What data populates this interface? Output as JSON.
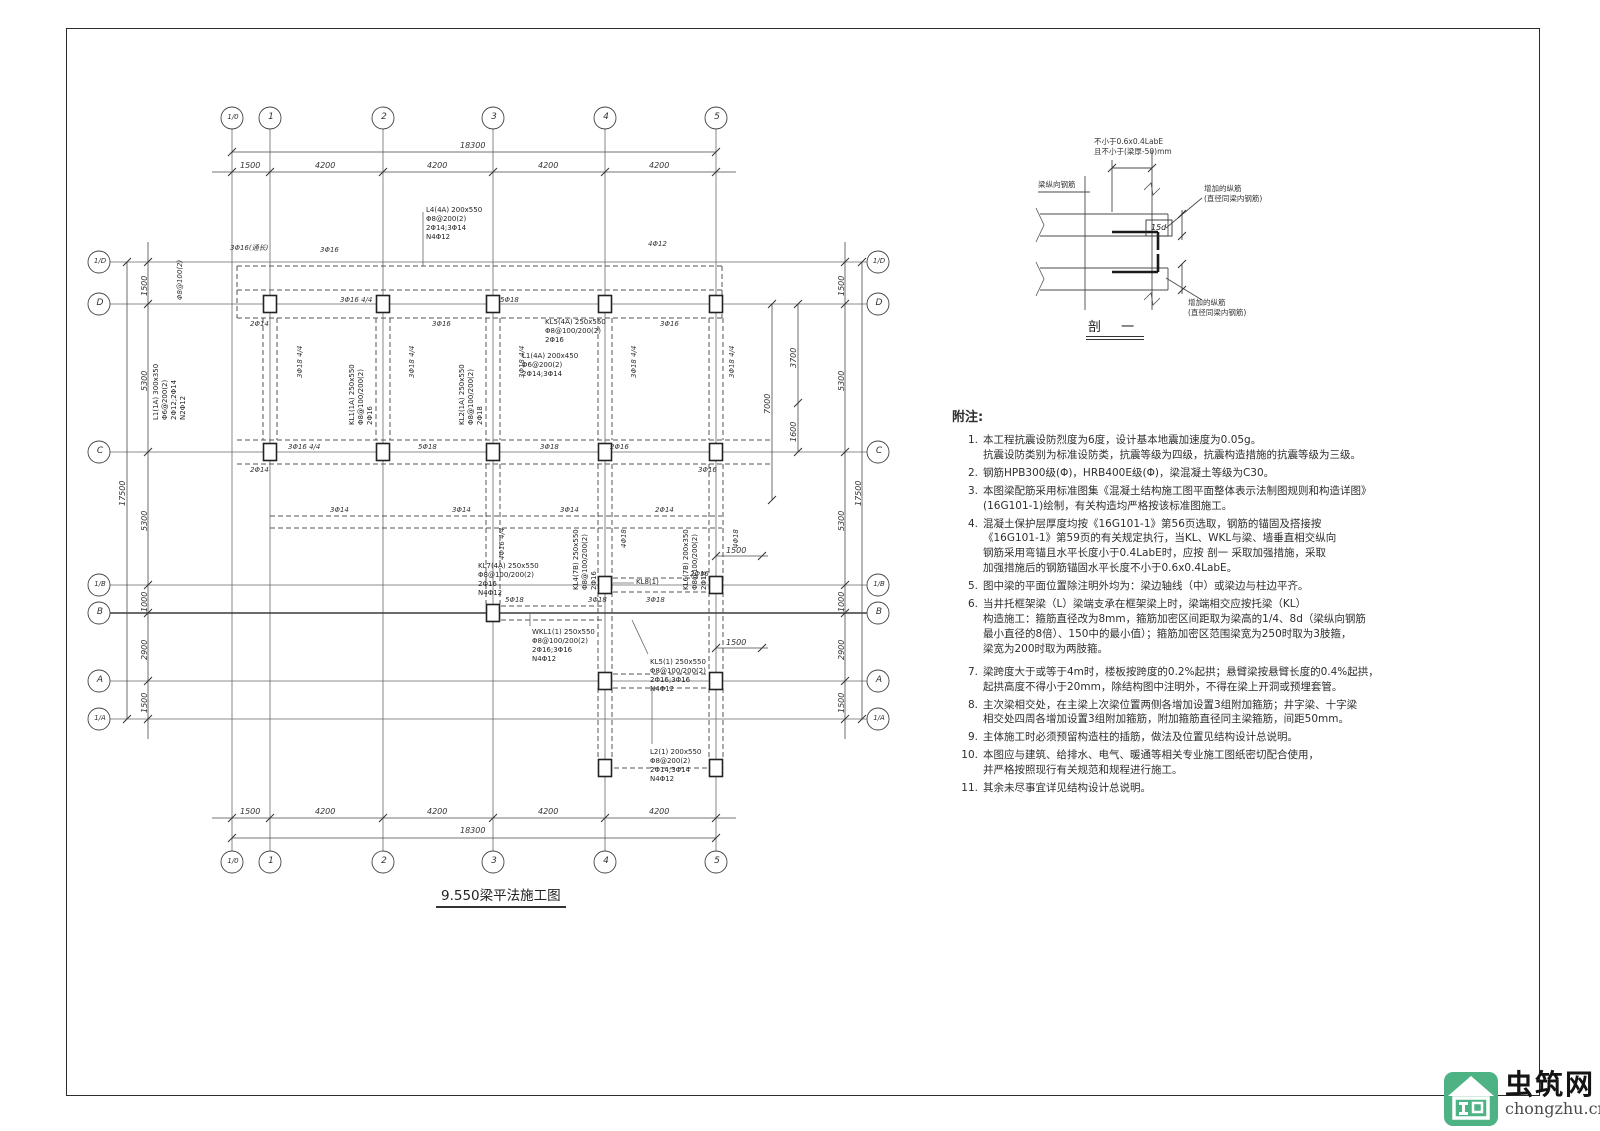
{
  "title": {
    "text": "9.550梁平法施工图"
  },
  "plan": {
    "axes_top": [
      "1/0",
      "1",
      "2",
      "3",
      "4",
      "5"
    ],
    "axes_bottom": [
      "1/0",
      "1",
      "2",
      "3",
      "4",
      "5"
    ],
    "axes_left": [
      "1/D",
      "D",
      "C",
      "1/B",
      "B",
      "A",
      "1/A"
    ],
    "axes_right": [
      "1/D",
      "D",
      "C",
      "1/B",
      "B",
      "A",
      "1/A"
    ],
    "dims_top": [
      "1500",
      "4200",
      "4200",
      "4200",
      "4200"
    ],
    "dims_top_total": "18300",
    "dims_bottom": [
      "1500",
      "4200",
      "4200",
      "4200",
      "4200"
    ],
    "dims_bottom_total": "18300",
    "dims_left": [
      "1500",
      "5300",
      "5300",
      "1000",
      "2900",
      "1500"
    ],
    "dims_left_total": "17500",
    "dims_right": [
      "1500",
      "5300",
      "5300",
      "1000",
      "2900",
      "1500"
    ],
    "dims_right_total": "17500",
    "dims_inner": [
      "7000",
      "3700",
      "1600",
      "1500",
      "1500"
    ],
    "labels": [
      "L4(4A) 200x550\nΦ8@200(2)\n2Φ14;3Φ14\nN4Φ12",
      "L1(1A) 300x350\nΦ6@200(2)\n2Φ12;2Φ14\nN2Φ12",
      "KL1(1A) 250x550\nΦ8@100/200(2)\n2Φ16",
      "KL2(1A) 250x550\nΦ8@100/200(2)\n2Φ18",
      "KL5(4A) 250x550\nΦ8@100/200(2)\n2Φ16",
      "L1(4A) 200x450\nΦ6@200(2)\n2Φ14;3Φ14",
      "KL7(4A) 250x550\nΦ8@100/200(2)\n2Φ16\nN4Φ12",
      "KL4(7B) 250x550\nΦ8@100/200(2)\n2Φ16",
      "KL6(7B) 200x350\nΦ8@100/200(2)\n2Φ18",
      "WKL1(1) 250x550\nΦ8@100/200(2)\n2Φ16;3Φ16\nN4Φ12",
      "KL5(1) 250x550\nΦ8@100/200(2)\n2Φ16;3Φ16\nN4Φ12",
      "L2(1) 200x550\nΦ8@200(2)\n2Φ14;3Φ14\nN4Φ12",
      "KL8(1)"
    ],
    "tags": [
      "3Φ16(通长)",
      "3Φ16",
      "4Φ12",
      "3Φ16 4/4",
      "5Φ18",
      "3Φ16",
      "3Φ16",
      "2Φ14",
      "Φ8@100(2)",
      "3Φ16 4/4",
      "2Φ14",
      "5Φ18",
      "3Φ18",
      "2Φ16",
      "3Φ16",
      "3Φ14",
      "3Φ14",
      "3Φ14",
      "2Φ14",
      "5Φ18",
      "3Φ18",
      "3Φ18",
      "2Φ16",
      "3Φ18 4/4",
      "3Φ18 4/4",
      "3Φ18 4/4",
      "3Φ18 4/4",
      "3Φ18 4/4",
      "4Φ16 4/4",
      "4Φ18",
      "4Φ18"
    ]
  },
  "detail": {
    "dim_note": "不小于0.6x0.4LabE\n且不小于(梁厚-50)mm",
    "left_label": "梁纵向钢筋",
    "right_label_top": "增加的纵筋\n(直径同梁内钢筋)",
    "right_label_bottom": "增加的纵筋\n(直径同梁内钢筋)",
    "box_label": "15d",
    "caption": "剖 一"
  },
  "notes": {
    "heading": "附注:",
    "items": [
      {
        "no": "1.",
        "text": "本工程抗震设防烈度为6度，设计基本地震加速度为0.05g。\n抗震设防类别为标准设防类，抗震等级为四级，抗震构造措施的抗震等级为三级。"
      },
      {
        "no": "2.",
        "text": "钢筋HPB300级(Φ)，HRB400E级(Φ)，梁混凝土等级为C30。"
      },
      {
        "no": "3.",
        "text": "本图梁配筋采用标准图集《混凝土结构施工图平面整体表示法制图规则和构造详图》\n(16G101-1)绘制，有关构造均严格按该标准图施工。"
      },
      {
        "no": "4.",
        "text": "混凝土保护层厚度均按《16G101-1》第56页选取，钢筋的锚固及搭接按\n《16G101-1》第59页的有关规定执行，当KL、WKL与梁、墙垂直相交纵向\n钢筋采用弯锚且水平长度小于0.4LabE时，应按 剖一 采取加强措施，采取\n加强措施后的钢筋锚固水平长度不小于0.6x0.4LabE。"
      },
      {
        "no": "5.",
        "text": "图中梁的平面位置除注明外均为：梁边轴线（中）或梁边与柱边平齐。"
      },
      {
        "no": "6.",
        "text": "当井托框架梁（L）梁端支承在框架梁上时，梁端相交应按托梁（KL）\n构造施工：箍筋直径改为8mm，箍筋加密区间距取为梁高的1/4、8d（梁纵向钢筋\n最小直径的8倍）、150中的最小值）；箍筋加密区范围梁宽为250时取为3肢箍，\n梁宽为200时取为两肢箍。"
      },
      {
        "no": "7.",
        "text": "梁跨度大于或等于4m时，楼板按跨度的0.2%起拱；悬臂梁按悬臂长度的0.4%起拱，\n起拱高度不得小于20mm，除结构图中注明外，不得在梁上开洞或预埋套管。"
      },
      {
        "no": "8.",
        "text": "主次梁相交处，在主梁上次梁位置两侧各增加设置3组附加箍筋；井字梁、十字梁\n相交处四周各增加设置3组附加箍筋，附加箍筋直径同主梁箍筋，间距50mm。"
      },
      {
        "no": "9.",
        "text": "主体施工时必须预留构造柱的插筋，做法及位置见结构设计总说明。"
      },
      {
        "no": "10.",
        "text": "本图应与建筑、给排水、电气、暖通等相关专业施工图纸密切配合使用，\n并严格按照现行有关规范和规程进行施工。"
      },
      {
        "no": "11.",
        "text": "其余未尽事宜详见结构设计总说明。"
      }
    ]
  },
  "logo": {
    "name": "虫筑网",
    "domain": "chongzhu.cn",
    "accent_color": "#4db385"
  }
}
